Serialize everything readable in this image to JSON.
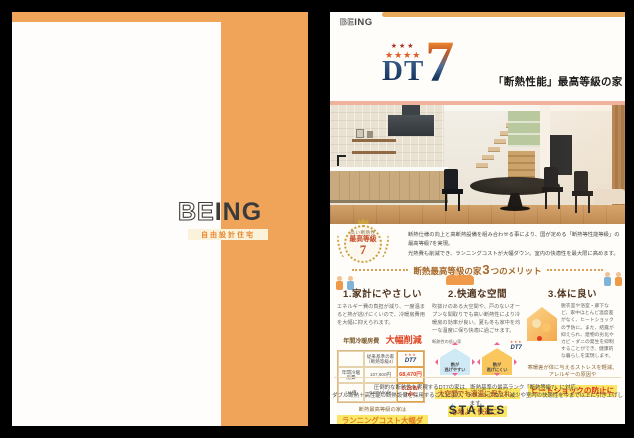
{
  "colors": {
    "cover_orange": "#f0a459",
    "accent_red": "#d84a2a",
    "highlight_yellow": "#fbe763",
    "logo_navy": "#17335c"
  },
  "left_page": {
    "be": "BE",
    "ing": "ING",
    "subtitle": "自由設計住宅"
  },
  "right_page": {
    "brand_be": "BE",
    "brand_ing": "ING",
    "stars_top": "★★★",
    "stars_bottom": "★★★★",
    "dt": "DT",
    "seven": "7",
    "dt7": "DT7",
    "mini_stars": "★★★",
    "tagline": "「断熱性能」最高等級の家",
    "badge": {
      "top": "高い断熱性",
      "mid": "最高等級",
      "num": "7"
    },
    "intro_line1": "断熱仕様の向上と高断熱設備を組み合わせる事により、国が定める「断熱等性能等級」の最高等級7を実現。",
    "intro_line2": "光熱費も削減でき、ランニングコストが大幅ダウン。室内の快適性を最大限に高めます。",
    "merits_heading": {
      "pre": "断熱最高等級の家",
      "num": "3",
      "post": "つのメリット"
    },
    "merits": [
      {
        "title": "1.家計にやさしい",
        "body": "エネルギー費の負担が減り、一度温まると熱が逃げにくいので、冷暖房費用を大幅に抑えられます。",
        "label": "年間冷暖房費",
        "label_em": "大幅削減",
        "table": {
          "h_old": "従来基準の家（断熱等級4）",
          "rows": [
            {
              "label": "年間冷暖房費",
              "old": "107,600円",
              "new": "68,470円"
            },
            {
              "label": "UA値",
              "old": "0.87W/㎡K",
              "new": "0.26W/㎡K"
            }
          ]
        },
        "foot1": "断熱最高等級の家は",
        "foot2": "ランニングコスト大幅ダウン"
      },
      {
        "title": "2.快適な空間",
        "body": "吹抜けのある大空間や、戸のないオープンな間取りでも高い断熱性により冷暖房の効率が良い。夏も冬も家中を均一な温度に保ち快適に過ごせます。",
        "house_low_caption": "断熱性の低い家",
        "house_low_l1": "熱が",
        "house_low_l2": "逃げやすい",
        "house_high_l1": "熱が",
        "house_high_l2": "逃げにくい",
        "foot1": "大空間でも適温に保たれ、",
        "foot2": "心地よく快適に！"
      },
      {
        "title": "3.体に良い",
        "body": "脱衣室や浴室・廊下など、家中ほとんど温度差がなく、ヒートショックの予防に。また、結露が抑えられ、建物の劣化やカビ・ダニの発生を抑制することができ、健康的な暮らしを実現します。",
        "foot1": "寒暖差が体に与えるストレスを軽減、",
        "foot2": "アレルギーの原因や",
        "foot3": "ヒートショックの防止に"
      }
    ],
    "footer_line1": "圧倒的な断熱性を実現するDT7の家は、断熱基準の最高ランク「断熱等級7」に対応。",
    "footer_line2": "ダブル断熱＋高性能の断熱設備を採用することにより、ランニングコスト減少や室内の快適性を今まで以上に引き上げします。",
    "states_logo": "STATES"
  }
}
